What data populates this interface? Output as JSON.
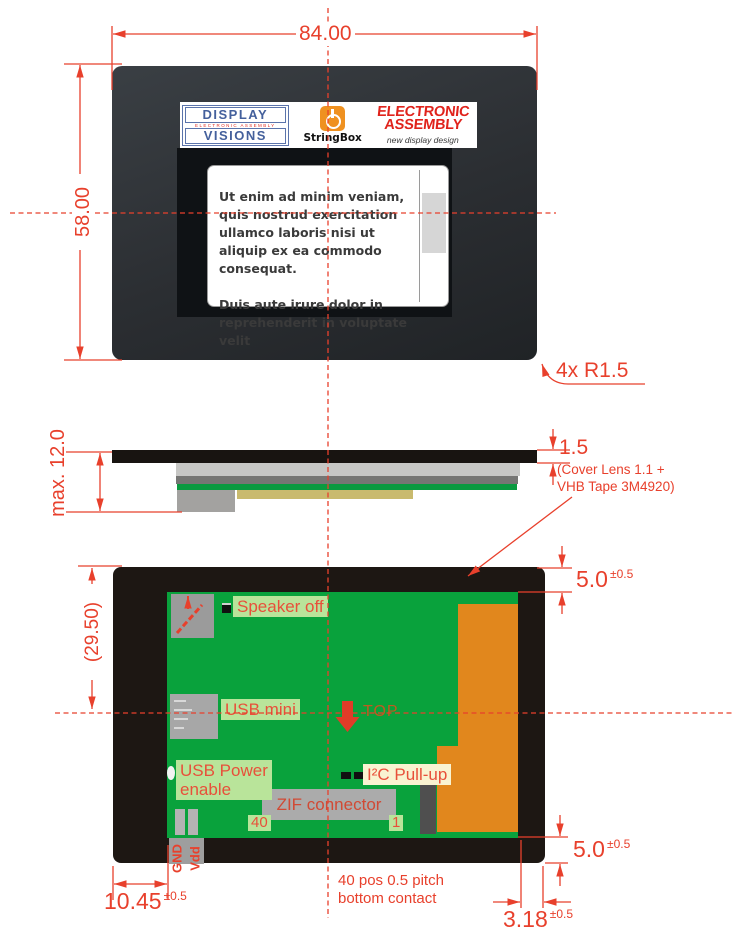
{
  "colors": {
    "dimension_red": "#e8402c",
    "pcb_green": "#09a23c",
    "component_orange": "#e1871d",
    "highlight_green": "#b9e49a",
    "highlight_yellow": "#f9f3d1",
    "logo_blue": "#44609c",
    "logo_red": "#e0231c"
  },
  "front": {
    "dim_width": "84.00",
    "dim_height": "58.00",
    "corner_radius_note": "4x R1.5",
    "sticker": {
      "dv_line1": "DISPLAY",
      "dv_line2": "ELECTRONIC ASSEMBLY",
      "dv_line3": "VISIONS",
      "stringbox": "StringBox",
      "ea_line1": "ELECTRONIC",
      "ea_line2": "ASSEMBLY",
      "ea_tagline": "new display design"
    },
    "screen": {
      "paragraph1": "Ut enim ad minim veniam, quis nostrud exercitation ullamco laboris nisi ut aliquip ex ea commodo consequat.",
      "paragraph2": "Duis aute irure dolor in reprehenderit in voluptate velit"
    }
  },
  "side": {
    "dim_max_height": "max. 12.0",
    "dim_lens": "1.5",
    "lens_note1": "(Cover Lens 1.1 +",
    "lens_note2": "VHB Tape 3M4920)"
  },
  "back": {
    "dim_overall": "(29.50)",
    "dim_top": "5.0",
    "dim_top_tol": "±0.5",
    "dim_bottom": "5.0",
    "dim_bottom_tol": "±0.5",
    "dim_left": "10.45",
    "dim_left_tol": "±0.5",
    "dim_contact": "3.18",
    "dim_contact_tol": "±0.5",
    "note_line1": "40 pos 0.5 pitch",
    "note_line2": "bottom contact",
    "speaker": "Speaker off",
    "usb_mini": "USB mini",
    "top_marker": "TOP",
    "usb_power1": "USB Power",
    "usb_power2": "enable",
    "i2c": "I²C Pull-up",
    "zif": "ZIF connector",
    "pin40": "40",
    "pin1": "1",
    "gnd": "GND",
    "vdd": "Vdd"
  }
}
